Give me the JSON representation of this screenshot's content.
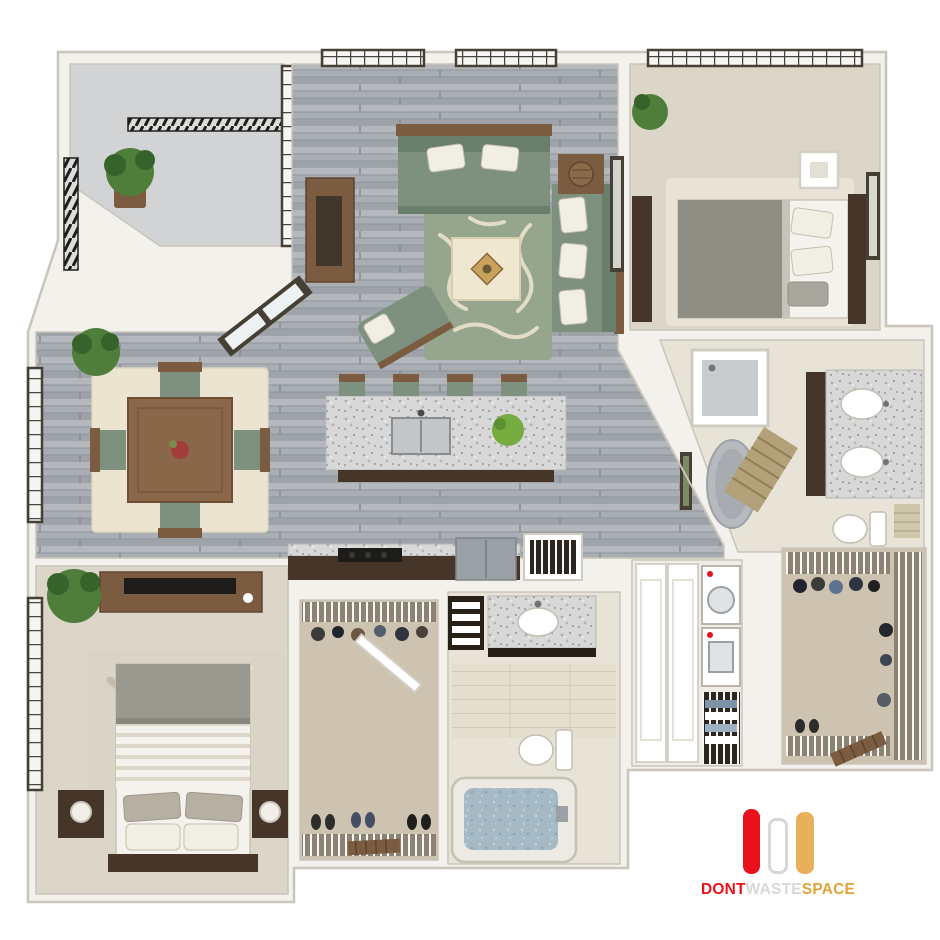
{
  "branding": {
    "logo": {
      "bars": [
        {
          "name": "red-bar",
          "color": "#e8111c"
        },
        {
          "name": "white-bar",
          "color": "#ffffff",
          "border": "#d7d7d7"
        },
        {
          "name": "gold-bar",
          "color": "#e8b05b"
        }
      ],
      "parts": [
        {
          "text": "DONT",
          "color": "#e8111c"
        },
        {
          "text": "WASTE",
          "color": "#d8d8d8"
        },
        {
          "text": "SPACE",
          "color": "#e1a33b"
        }
      ]
    }
  },
  "scene": {
    "type": "3d-floor-plan",
    "view": "top-down",
    "description": "Two-bedroom two-bathroom apartment 3D floor plan render",
    "rooms": [
      {
        "name": "balcony",
        "floor": "concrete",
        "items": [
          "black-railing",
          "potted-plant"
        ]
      },
      {
        "name": "living-room",
        "floor": "gray-wood-plank",
        "items": [
          "sofa",
          "loveseat",
          "chaise-lounge",
          "coffee-table",
          "patterned-area-rug",
          "media-console",
          "side-table-with-basket",
          "wall-art",
          "french-doors",
          "grid-windows"
        ]
      },
      {
        "name": "dining-room",
        "floor": "gray-wood-plank",
        "items": [
          "square-wood-table",
          "four-chairs-green-seats",
          "cream-rug",
          "fern-plant",
          "grid-window"
        ]
      },
      {
        "name": "kitchen",
        "floor": "gray-wood-plank",
        "items": [
          "granite-island-with-sink",
          "four-bar-stools",
          "island-plant",
          "dark-counter",
          "cooktop",
          "fridge",
          "wire-pantry"
        ]
      },
      {
        "name": "bedroom-2",
        "floor": "beige-carpet",
        "items": [
          "bed-gray-blanket",
          "dark-headboard",
          "white-cube-nightstand",
          "dresser",
          "wall-art",
          "plant",
          "grid-window",
          "area-rug"
        ]
      },
      {
        "name": "bathroom-2",
        "floor": "beige-tile",
        "items": [
          "double-vanity-granite",
          "two-oval-sinks",
          "shower",
          "soaking-tub",
          "bamboo-mat",
          "toilet",
          "towels",
          "wall-art"
        ]
      },
      {
        "name": "master-bedroom",
        "floor": "beige-carpet",
        "items": [
          "bed-white-striped-duvet",
          "pillows",
          "dark-headboard",
          "two-nightstands-with-lamps",
          "dresser-with-tv",
          "palm-plant",
          "leaf-pattern-rug",
          "grid-window"
        ]
      },
      {
        "name": "walk-in-closet-1",
        "floor": "tan-carpet",
        "items": [
          "wire-shelving",
          "hanging-clothes",
          "shoes",
          "shoe-rack",
          "door"
        ]
      },
      {
        "name": "master-bathroom",
        "floor": "light-tile",
        "items": [
          "granite-vanity",
          "oval-sink",
          "linen-shelves",
          "toilet",
          "bathtub-with-water"
        ]
      },
      {
        "name": "laundry-closet",
        "floor": "white",
        "items": [
          "stacked-washer-dryer",
          "double-doors",
          "wire-shelf-with-linens"
        ]
      },
      {
        "name": "walk-in-closet-2",
        "floor": "tan-carpet",
        "items": [
          "wire-shelving",
          "hanging-clothes",
          "shoes",
          "wood-rack"
        ]
      }
    ]
  },
  "palette": {
    "wall": "#f3f1eb",
    "wall-edge": "#c9c5ba",
    "frame": "#453f34",
    "sofa": "#7e917f",
    "sofa-dark": "#697f6c",
    "wood": "#7b5c40",
    "wood-dark": "#46362a",
    "carpet": "#dcd6c8",
    "carpet-dark": "#cdc3b0",
    "tile": "#e8e3d7",
    "balcony-floor": "#d2d3d5",
    "cream": "#efe7cf",
    "rug-green": "#96a58e",
    "rug-cream": "#e9e3cc",
    "dark": "#1e1c19",
    "steel": "#9aa0a4",
    "plant": "#4e7e3a",
    "plant-dark": "#35632a",
    "logo-red": "#e8111c",
    "logo-gold": "#e8b05b",
    "logo-gray": "#d8d8d8"
  }
}
